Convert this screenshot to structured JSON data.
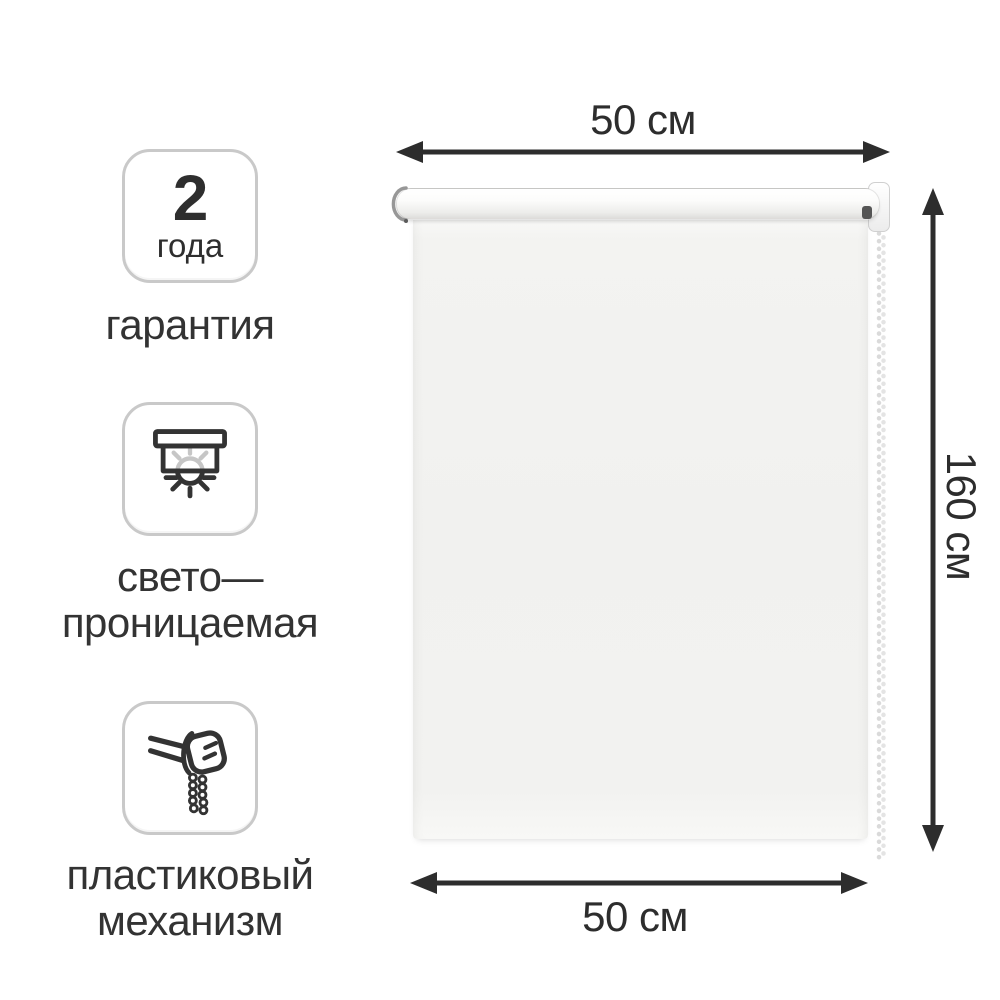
{
  "product": {
    "kind": "roller-blind-dimension-infographic"
  },
  "features": [
    {
      "id": "warranty",
      "icon": "warranty-2-years-badge",
      "badge": {
        "value": "2",
        "unit": "года"
      },
      "labels": [
        "гарантия"
      ]
    },
    {
      "id": "light-transmitting",
      "icon": "blind-with-sun-icon",
      "labels": [
        "свето—",
        "проницаемая"
      ]
    },
    {
      "id": "plastic-mechanism",
      "icon": "roller-mechanism-chain-icon",
      "labels": [
        "пластиковый",
        "механизм"
      ]
    }
  ],
  "dimensions": {
    "top": "50 см",
    "bottom": "50 см",
    "side": "160 см"
  },
  "colors": {
    "text": "#2e2e2e",
    "arrow": "#2d2d2d",
    "badge_border": "#c9c9c9",
    "icon_stroke": "#333333",
    "icon_stroke_light": "#c6c6c6",
    "fabric": "#f2f2f0",
    "chain_beads": "#dadada"
  }
}
